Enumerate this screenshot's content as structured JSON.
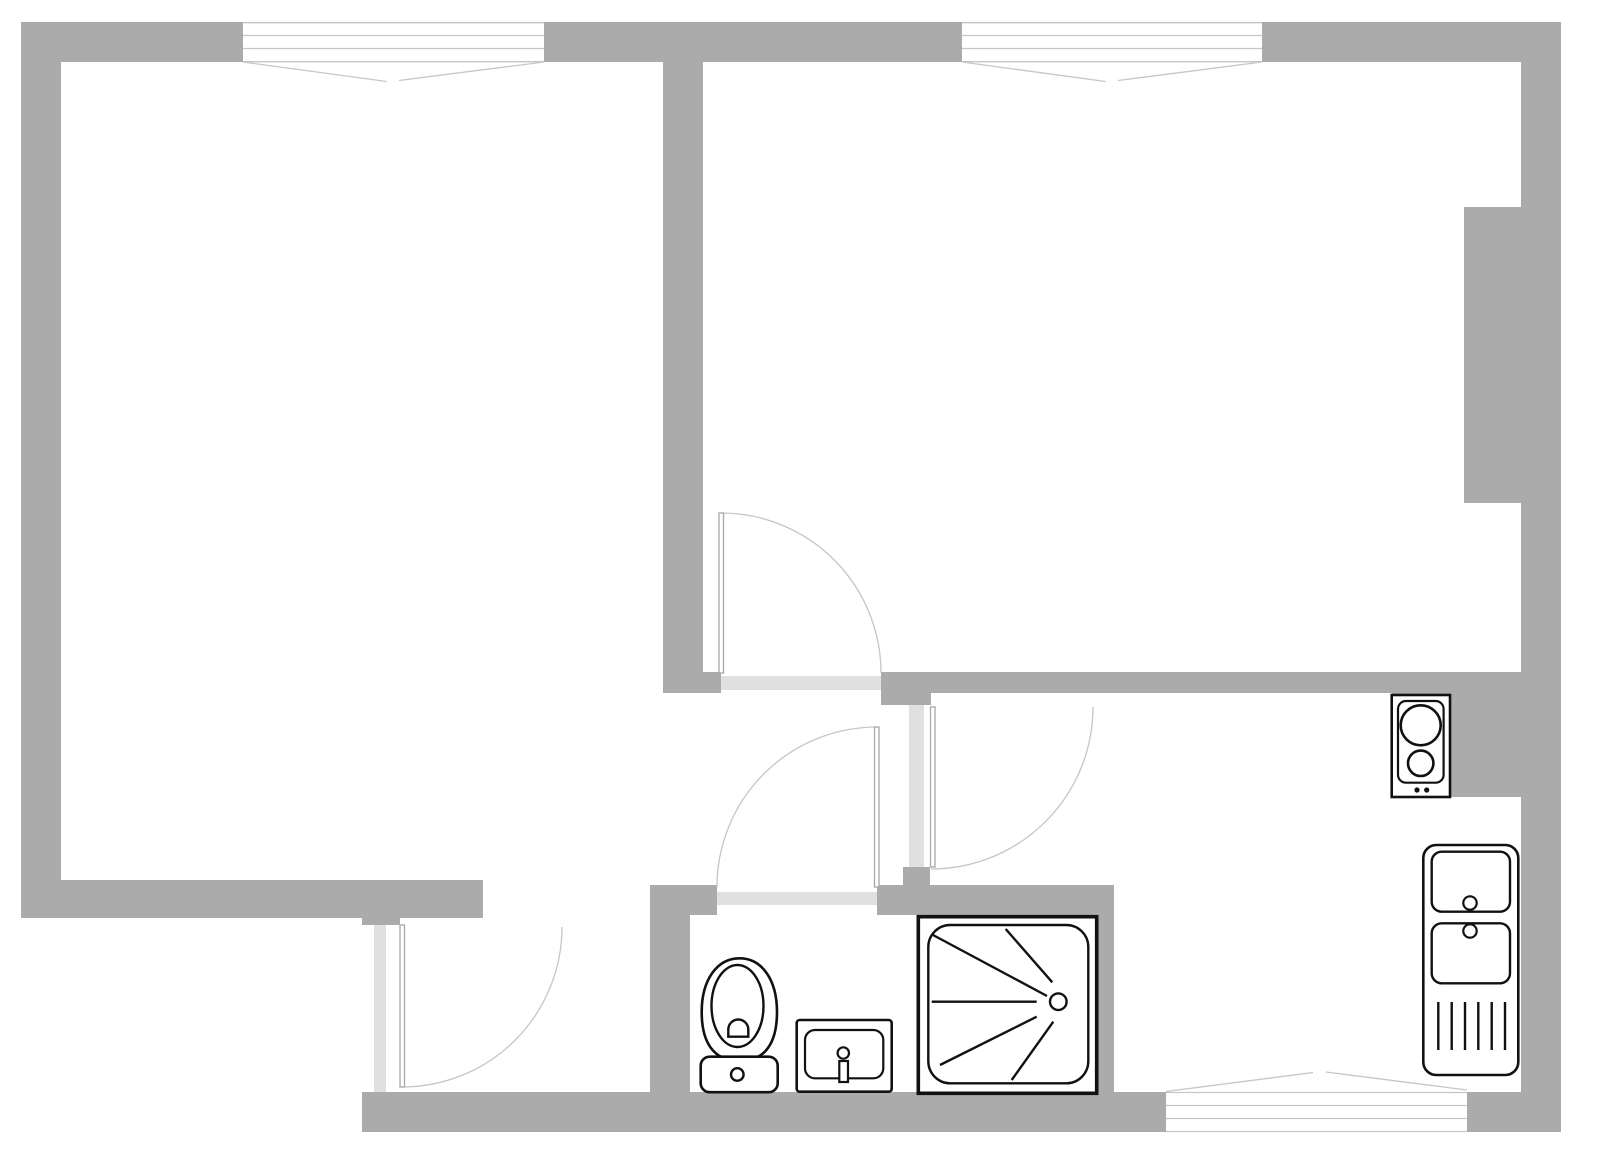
{
  "title": "apartment-floor-plan",
  "canvas": {
    "width": 1600,
    "height": 1156
  },
  "colors": {
    "wall": "#ababab",
    "floor": "#ffffff",
    "threshold": "#e0e0e0",
    "thin_line": "#c6c6c6",
    "leaf_stroke": "#a8a8a8",
    "fixture": "#111111"
  },
  "rects": [
    {
      "name": "wall-top-left",
      "x": 21,
      "y": 22,
      "w": 222,
      "h": 40,
      "fill": "wall"
    },
    {
      "name": "wall-top-middle",
      "x": 544,
      "y": 22,
      "w": 418,
      "h": 40,
      "fill": "wall"
    },
    {
      "name": "wall-top-right",
      "x": 1262,
      "y": 22,
      "w": 299,
      "h": 40,
      "fill": "wall"
    },
    {
      "name": "wall-left",
      "x": 21,
      "y": 22,
      "w": 40,
      "h": 896,
      "fill": "wall"
    },
    {
      "name": "wall-right",
      "x": 1521,
      "y": 22,
      "w": 40,
      "h": 1110,
      "fill": "wall"
    },
    {
      "name": "wall-right-pier",
      "x": 1464,
      "y": 207,
      "w": 57,
      "h": 296,
      "fill": "wall"
    },
    {
      "name": "wall-rooms-divider",
      "x": 663,
      "y": 62,
      "w": 40,
      "h": 631,
      "fill": "wall"
    },
    {
      "name": "wall-hall-top",
      "x": 663,
      "y": 672,
      "w": 858,
      "h": 21,
      "fill": "wall"
    },
    {
      "name": "wall-hall-pillar",
      "x": 881,
      "y": 672,
      "w": 50,
      "h": 33,
      "fill": "wall"
    },
    {
      "name": "wall-kitchen-hall-divider-stub",
      "x": 903,
      "y": 867,
      "w": 27,
      "h": 20,
      "fill": "wall"
    },
    {
      "name": "wall-kitchen-counter-block",
      "x": 1392,
      "y": 672,
      "w": 129,
      "h": 125,
      "fill": "wall"
    },
    {
      "name": "wall-bathroom-top",
      "x": 650,
      "y": 885,
      "w": 464,
      "h": 30,
      "fill": "wall"
    },
    {
      "name": "wall-bathroom-left",
      "x": 650,
      "y": 885,
      "w": 40,
      "h": 207,
      "fill": "wall"
    },
    {
      "name": "wall-bathroom-kitchen-divider",
      "x": 1097,
      "y": 885,
      "w": 17,
      "h": 207,
      "fill": "wall"
    },
    {
      "name": "wall-livingroom-bottom",
      "x": 21,
      "y": 880,
      "w": 462,
      "h": 38,
      "fill": "wall"
    },
    {
      "name": "wall-entry-stub",
      "x": 362,
      "y": 880,
      "w": 38,
      "h": 45,
      "fill": "wall"
    },
    {
      "name": "wall-bottom-left",
      "x": 362,
      "y": 1092,
      "w": 804,
      "h": 40,
      "fill": "wall"
    },
    {
      "name": "wall-bottom-right",
      "x": 1467,
      "y": 1092,
      "w": 94,
      "h": 40,
      "fill": "wall"
    },
    {
      "name": "doorway-bedroom",
      "x": 721,
      "y": 672,
      "w": 160,
      "h": 21,
      "fill": "floor"
    },
    {
      "name": "doorway-bedroom-threshold",
      "x": 721,
      "y": 676,
      "w": 160,
      "h": 14,
      "fill": "threshold"
    },
    {
      "name": "doorway-kitchen",
      "x": 903,
      "y": 705,
      "w": 27,
      "h": 162,
      "fill": "floor"
    },
    {
      "name": "doorway-kitchen-threshold",
      "x": 909,
      "y": 705,
      "w": 15,
      "h": 162,
      "fill": "threshold"
    },
    {
      "name": "doorway-bathroom",
      "x": 717,
      "y": 885,
      "w": 160,
      "h": 30,
      "fill": "floor"
    },
    {
      "name": "doorway-bathroom-threshold",
      "x": 717,
      "y": 892,
      "w": 160,
      "h": 13,
      "fill": "threshold"
    },
    {
      "name": "doorway-entry",
      "x": 362,
      "y": 925,
      "w": 38,
      "h": 167,
      "fill": "floor"
    },
    {
      "name": "doorway-entry-threshold",
      "x": 374,
      "y": 925,
      "w": 12,
      "h": 167,
      "fill": "threshold"
    },
    {
      "name": "window-livingroom",
      "x": 243,
      "y": 22,
      "w": 301,
      "h": 40,
      "fill": "floor"
    },
    {
      "name": "window-bedroom",
      "x": 962,
      "y": 22,
      "w": 300,
      "h": 40,
      "fill": "floor"
    },
    {
      "name": "window-kitchen",
      "x": 1166,
      "y": 1092,
      "w": 301,
      "h": 40,
      "fill": "floor"
    }
  ],
  "svg_shapes": [
    {
      "name": "window-livingroom-line-1",
      "type": "line",
      "x1": 243,
      "y1": 22.7,
      "x2": 544,
      "y2": 22.7,
      "stroke": "thin_line",
      "sw": 1.3
    },
    {
      "name": "window-livingroom-line-2",
      "type": "line",
      "x1": 243,
      "y1": 35.5,
      "x2": 544,
      "y2": 35.5,
      "stroke": "thin_line",
      "sw": 1.3
    },
    {
      "name": "window-livingroom-line-3",
      "type": "line",
      "x1": 243,
      "y1": 48.5,
      "x2": 544,
      "y2": 48.5,
      "stroke": "thin_line",
      "sw": 1.3
    },
    {
      "name": "window-livingroom-line-4",
      "type": "line",
      "x1": 243,
      "y1": 61.7,
      "x2": 544,
      "y2": 61.7,
      "stroke": "thin_line",
      "sw": 1.3
    },
    {
      "name": "window-livingroom-sash-left",
      "type": "line",
      "x1": 243,
      "y1": 62,
      "x2": 386.5,
      "y2": 81.5,
      "stroke": "thin_line",
      "sw": 1.3
    },
    {
      "name": "window-livingroom-sash-right",
      "type": "line",
      "x1": 399,
      "y1": 80.5,
      "x2": 544,
      "y2": 62,
      "stroke": "thin_line",
      "sw": 1.3
    },
    {
      "name": "window-bedroom-line-1",
      "type": "line",
      "x1": 962,
      "y1": 22.7,
      "x2": 1262,
      "y2": 22.7,
      "stroke": "thin_line",
      "sw": 1.3
    },
    {
      "name": "window-bedroom-line-2",
      "type": "line",
      "x1": 962,
      "y1": 35.5,
      "x2": 1262,
      "y2": 35.5,
      "stroke": "thin_line",
      "sw": 1.3
    },
    {
      "name": "window-bedroom-line-3",
      "type": "line",
      "x1": 962,
      "y1": 48.5,
      "x2": 1262,
      "y2": 48.5,
      "stroke": "thin_line",
      "sw": 1.3
    },
    {
      "name": "window-bedroom-line-4",
      "type": "line",
      "x1": 962,
      "y1": 61.7,
      "x2": 1262,
      "y2": 61.7,
      "stroke": "thin_line",
      "sw": 1.3
    },
    {
      "name": "window-bedroom-sash-left",
      "type": "line",
      "x1": 962,
      "y1": 62,
      "x2": 1105.5,
      "y2": 81.5,
      "stroke": "thin_line",
      "sw": 1.3
    },
    {
      "name": "window-bedroom-sash-right",
      "type": "line",
      "x1": 1118,
      "y1": 80.5,
      "x2": 1262,
      "y2": 62,
      "stroke": "thin_line",
      "sw": 1.3
    },
    {
      "name": "window-kitchen-line-1",
      "type": "line",
      "x1": 1166,
      "y1": 1092.5,
      "x2": 1467,
      "y2": 1092.5,
      "stroke": "thin_line",
      "sw": 1.3
    },
    {
      "name": "window-kitchen-line-2",
      "type": "line",
      "x1": 1166,
      "y1": 1105.5,
      "x2": 1467,
      "y2": 1105.5,
      "stroke": "thin_line",
      "sw": 1.3
    },
    {
      "name": "window-kitchen-line-3",
      "type": "line",
      "x1": 1166,
      "y1": 1118.5,
      "x2": 1467,
      "y2": 1118.5,
      "stroke": "thin_line",
      "sw": 1.3
    },
    {
      "name": "window-kitchen-line-4",
      "type": "line",
      "x1": 1166,
      "y1": 1131.5,
      "x2": 1467,
      "y2": 1131.5,
      "stroke": "thin_line",
      "sw": 1.3
    },
    {
      "name": "window-kitchen-sash-left",
      "type": "line",
      "x1": 1166,
      "y1": 1091.5,
      "x2": 1313,
      "y2": 1072.5,
      "stroke": "thin_line",
      "sw": 1.3
    },
    {
      "name": "window-kitchen-sash-right",
      "type": "line",
      "x1": 1326,
      "y1": 1072,
      "x2": 1467,
      "y2": 1090,
      "stroke": "thin_line",
      "sw": 1.3
    },
    {
      "name": "door-arc-bedroom",
      "type": "path",
      "d": "M 721 513 A 160 160 0 0 1 881 673",
      "stroke": "thin_line",
      "sw": 1.3,
      "fill": "none"
    },
    {
      "name": "door-leaf-bedroom",
      "type": "rect",
      "x": 719,
      "y": 513,
      "w": 4.5,
      "h": 160,
      "rx": 0,
      "stroke": "leaf_stroke",
      "sw": 1.3,
      "fill": "floor"
    },
    {
      "name": "door-arc-kitchen",
      "type": "path",
      "d": "M 1093 707 A 162 162 0 0 1 931 869",
      "stroke": "thin_line",
      "sw": 1.3,
      "fill": "none"
    },
    {
      "name": "door-leaf-kitchen",
      "type": "rect",
      "x": 930.5,
      "y": 707,
      "w": 4.5,
      "h": 160,
      "rx": 0,
      "stroke": "leaf_stroke",
      "sw": 1.3,
      "fill": "floor"
    },
    {
      "name": "door-arc-bathroom",
      "type": "path",
      "d": "M 877 727 A 160 160 0 0 0 717 887",
      "stroke": "thin_line",
      "sw": 1.3,
      "fill": "none"
    },
    {
      "name": "door-leaf-bathroom",
      "type": "rect",
      "x": 874.5,
      "y": 727,
      "w": 4.5,
      "h": 160,
      "rx": 0,
      "stroke": "leaf_stroke",
      "sw": 1.3,
      "fill": "floor"
    },
    {
      "name": "door-arc-entry",
      "type": "path",
      "d": "M 562 927 A 160 160 0 0 1 402 1087",
      "stroke": "thin_line",
      "sw": 1.3,
      "fill": "none"
    },
    {
      "name": "door-leaf-entry",
      "type": "rect",
      "x": 400,
      "y": 925,
      "w": 4.5,
      "h": 162,
      "rx": 0,
      "stroke": "leaf_stroke",
      "sw": 1.3,
      "fill": "floor"
    },
    {
      "name": "toilet-bowl",
      "type": "path",
      "d": "M 739.5 958.3 C 717 958.3 701.7 980 701.7 1012 C 701.7 1041 712.5 1061 739.5 1061 C 766.5 1061 777 1041 777 1012 C 777 980 762 958.3 739.5 958.3 Z",
      "stroke": "fixture",
      "sw": 2.6,
      "fill": "floor"
    },
    {
      "name": "toilet-bowl-inner",
      "type": "ellipse",
      "cx": 737.5,
      "cy": 1006,
      "rx": 26,
      "ry": 41,
      "stroke": "fixture",
      "sw": 2.4,
      "fill": "floor"
    },
    {
      "name": "toilet-drain",
      "type": "path",
      "d": "M 728.3 1036.7 L 728.3 1029.5 A 10 10 0 0 1 748.3 1029.5 L 748.3 1036.7 Z",
      "stroke": "fixture",
      "sw": 2.4,
      "fill": "floor"
    },
    {
      "name": "toilet-tank",
      "type": "rect",
      "x": 700.7,
      "y": 1056.7,
      "w": 77,
      "h": 35.5,
      "rx": 9,
      "stroke": "fixture",
      "sw": 2.6,
      "fill": "floor"
    },
    {
      "name": "toilet-flush-button",
      "type": "circle",
      "cx": 737.3,
      "cy": 1074.5,
      "r": 6.3,
      "stroke": "fixture",
      "sw": 2.4,
      "fill": "floor"
    },
    {
      "name": "washbasin-counter",
      "type": "rect",
      "x": 796.7,
      "y": 1020,
      "w": 95,
      "h": 71.7,
      "rx": 3,
      "stroke": "fixture",
      "sw": 2.6,
      "fill": "floor"
    },
    {
      "name": "washbasin-basin",
      "type": "rect",
      "x": 805,
      "y": 1030,
      "w": 78.3,
      "h": 48.3,
      "rx": 10,
      "stroke": "fixture",
      "sw": 2.2,
      "fill": "floor"
    },
    {
      "name": "washbasin-faucet-stem",
      "type": "rect",
      "x": 839.3,
      "y": 1061,
      "w": 8.7,
      "h": 21,
      "rx": 0,
      "stroke": "fixture",
      "sw": 2.2,
      "fill": "floor"
    },
    {
      "name": "washbasin-faucet",
      "type": "circle",
      "cx": 843.3,
      "cy": 1053,
      "r": 5.7,
      "stroke": "fixture",
      "sw": 2.2,
      "fill": "floor"
    },
    {
      "name": "shower-tray",
      "type": "rect",
      "x": 918.3,
      "y": 916.7,
      "w": 178.4,
      "h": 176.6,
      "rx": 0,
      "stroke": "fixture",
      "sw": 3.6,
      "fill": "floor"
    },
    {
      "name": "shower-basin",
      "type": "rect",
      "x": 928.3,
      "y": 925,
      "w": 160,
      "h": 158.3,
      "rx": 22,
      "stroke": "fixture",
      "sw": 2.4,
      "fill": "none"
    },
    {
      "name": "shower-ray-1",
      "type": "line",
      "x1": 933,
      "y1": 935,
      "x2": 1047,
      "y2": 996,
      "stroke": "fixture",
      "sw": 2.4
    },
    {
      "name": "shower-ray-2",
      "type": "line",
      "x1": 1005.7,
      "y1": 929,
      "x2": 1052.3,
      "y2": 982.3,
      "stroke": "fixture",
      "sw": 2.4
    },
    {
      "name": "shower-ray-3",
      "type": "line",
      "x1": 931.7,
      "y1": 1001.7,
      "x2": 1036.7,
      "y2": 1001.7,
      "stroke": "fixture",
      "sw": 2.4
    },
    {
      "name": "shower-ray-4",
      "type": "line",
      "x1": 940,
      "y1": 1065,
      "x2": 1036.7,
      "y2": 1016.7,
      "stroke": "fixture",
      "sw": 2.4
    },
    {
      "name": "shower-ray-5",
      "type": "line",
      "x1": 1011.7,
      "y1": 1080,
      "x2": 1053.3,
      "y2": 1021.7,
      "stroke": "fixture",
      "sw": 2.4
    },
    {
      "name": "shower-drain",
      "type": "circle",
      "cx": 1058.3,
      "cy": 1001.7,
      "r": 8.3,
      "stroke": "fixture",
      "sw": 2.4,
      "fill": "floor"
    },
    {
      "name": "stove-body",
      "type": "rect",
      "x": 1391.7,
      "y": 695,
      "w": 58.3,
      "h": 102,
      "rx": 0,
      "stroke": "fixture",
      "sw": 2.6,
      "fill": "floor"
    },
    {
      "name": "stove-surface",
      "type": "rect",
      "x": 1398,
      "y": 701,
      "w": 45.6,
      "h": 81.7,
      "rx": 8,
      "stroke": "fixture",
      "sw": 2.2,
      "fill": "none"
    },
    {
      "name": "stove-burner-large",
      "type": "circle",
      "cx": 1420.7,
      "cy": 725.3,
      "r": 20,
      "stroke": "fixture",
      "sw": 2.6,
      "fill": "none"
    },
    {
      "name": "stove-burner-small",
      "type": "circle",
      "cx": 1420.7,
      "cy": 763.3,
      "r": 12.7,
      "stroke": "fixture",
      "sw": 2.6,
      "fill": "none"
    },
    {
      "name": "stove-knob-left",
      "type": "circle",
      "cx": 1417,
      "cy": 790,
      "r": 2.6,
      "stroke": "none",
      "sw": 0,
      "fill": "fixture"
    },
    {
      "name": "stove-knob-right",
      "type": "circle",
      "cx": 1426.7,
      "cy": 790,
      "r": 2.6,
      "stroke": "none",
      "sw": 0,
      "fill": "fixture"
    },
    {
      "name": "kitchen-sink-counter",
      "type": "rect",
      "x": 1423.3,
      "y": 845,
      "w": 95,
      "h": 230,
      "rx": 13,
      "stroke": "fixture",
      "sw": 2.6,
      "fill": "floor"
    },
    {
      "name": "kitchen-sink-basin-upper",
      "type": "rect",
      "x": 1431.7,
      "y": 851.7,
      "w": 78.3,
      "h": 60,
      "rx": 10,
      "stroke": "fixture",
      "sw": 2.4,
      "fill": "none"
    },
    {
      "name": "kitchen-sink-basin-lower",
      "type": "rect",
      "x": 1431.7,
      "y": 923.3,
      "w": 78.3,
      "h": 60,
      "rx": 10,
      "stroke": "fixture",
      "sw": 2.4,
      "fill": "none"
    },
    {
      "name": "kitchen-sink-faucet-upper",
      "type": "circle",
      "cx": 1470,
      "cy": 903,
      "r": 6.7,
      "stroke": "fixture",
      "sw": 2.2,
      "fill": "floor"
    },
    {
      "name": "kitchen-sink-faucet-lower",
      "type": "circle",
      "cx": 1470,
      "cy": 931,
      "r": 6.7,
      "stroke": "fixture",
      "sw": 2.2,
      "fill": "floor"
    },
    {
      "name": "kitchen-sink-drainboard-line-1",
      "type": "line",
      "x1": 1438.3,
      "y1": 1002,
      "x2": 1438.3,
      "y2": 1050,
      "stroke": "fixture",
      "sw": 2.4
    },
    {
      "name": "kitchen-sink-drainboard-line-2",
      "type": "line",
      "x1": 1451.7,
      "y1": 1002,
      "x2": 1451.7,
      "y2": 1050,
      "stroke": "fixture",
      "sw": 2.4
    },
    {
      "name": "kitchen-sink-drainboard-line-3",
      "type": "line",
      "x1": 1465,
      "y1": 1002,
      "x2": 1465,
      "y2": 1050,
      "stroke": "fixture",
      "sw": 2.4
    },
    {
      "name": "kitchen-sink-drainboard-line-4",
      "type": "line",
      "x1": 1478.3,
      "y1": 1002,
      "x2": 1478.3,
      "y2": 1050,
      "stroke": "fixture",
      "sw": 2.4
    },
    {
      "name": "kitchen-sink-drainboard-line-5",
      "type": "line",
      "x1": 1491.7,
      "y1": 1002,
      "x2": 1491.7,
      "y2": 1050,
      "stroke": "fixture",
      "sw": 2.4
    },
    {
      "name": "kitchen-sink-drainboard-line-6",
      "type": "line",
      "x1": 1505,
      "y1": 1002,
      "x2": 1505,
      "y2": 1050,
      "stroke": "fixture",
      "sw": 2.4
    }
  ]
}
